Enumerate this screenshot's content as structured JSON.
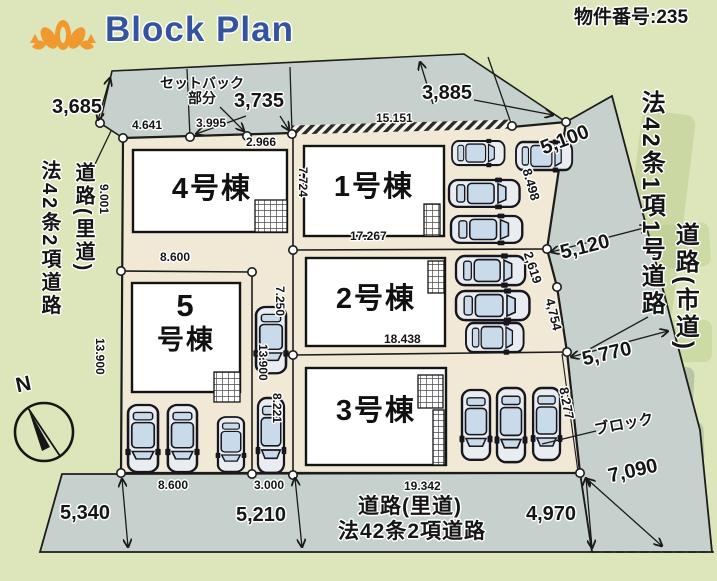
{
  "header": {
    "title": "Block Plan",
    "property_number": "物件番号:235"
  },
  "compass": {
    "north": "N"
  },
  "buildings": {
    "b1": "1号棟",
    "b2": "2号棟",
    "b3": "3号棟",
    "b4": "4号棟",
    "b5_top": "5",
    "b5_bottom": "号棟"
  },
  "roads": {
    "left_law": "法42条2項道路",
    "left_name": "道路(里道)",
    "right_law": "法42条1項1号道路",
    "right_name": "道路(市道)",
    "bottom_name": "道路(里道)",
    "bottom_law": "法42条2項道路",
    "setback": "セットバック\n部分",
    "block_wall": "ブロック"
  },
  "dimensions": {
    "top_left_3685": "3,685",
    "top_3735": "3,735",
    "top_3885": "3,885",
    "seg_15151": "15.151",
    "seg_4641": "4.641",
    "seg_3995": "3.995",
    "seg_2966": "2.966",
    "road_5100": "5,100",
    "edge_8498": "8.498",
    "road_5120": "5,120",
    "edge_2619": "2,619",
    "edge_4754": "4,754",
    "road_5770": "5,770",
    "edge_8277": "8.277",
    "road_7090": "7,090",
    "road_4970": "4,970",
    "bottom_19342": "19.342",
    "road_5210": "5,210",
    "bottom_8600": "8.600",
    "bottom_3000": "3.000",
    "road_5340": "5,340",
    "lot5_8600": "8.600",
    "left_9001": "9.001",
    "left_13900": "13.900",
    "lot1_7724": "7.724",
    "lot1_17267": "17.267",
    "lot2_18438": "18.438",
    "strip_7250": "7.250",
    "strip_13900": "13.900",
    "strip_8221": "8.221"
  },
  "colors": {
    "background": "#dce6ba",
    "road_gray": "#c6d1cd",
    "lot_beige": "#f1e8d5",
    "title_blue": "#34549e",
    "logo_orange": "#ef9930"
  }
}
